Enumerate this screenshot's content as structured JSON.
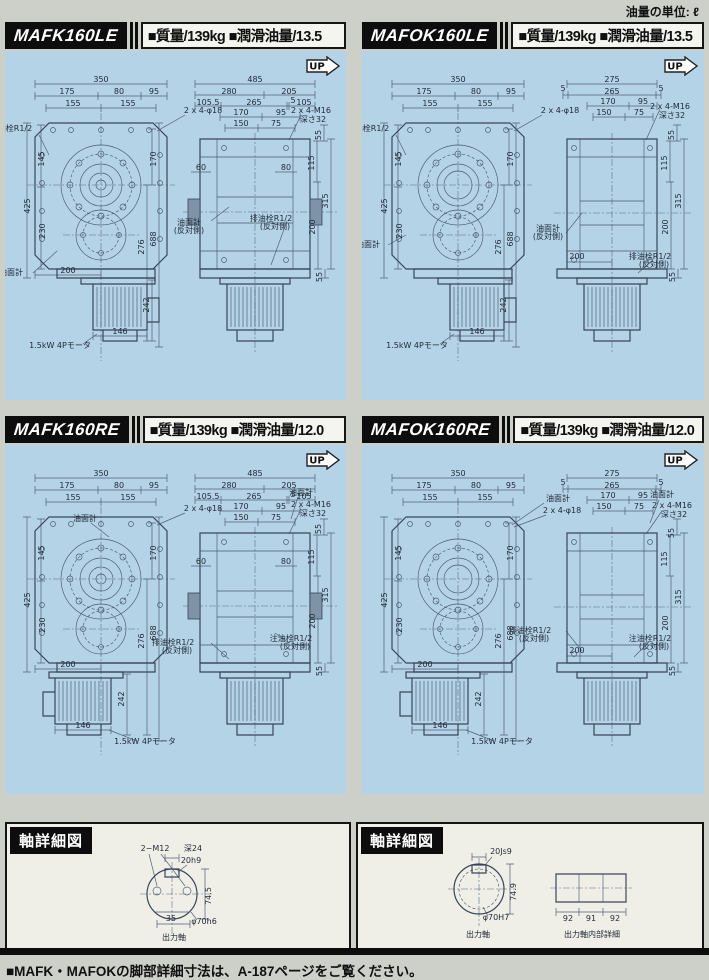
{
  "page": {
    "unit_note": "油量の単位: ℓ",
    "up_label": "UP",
    "footer": "■MAFK・MAFOKの脚部詳細寸法は、A-187ページをご覧ください。"
  },
  "panels": [
    {
      "model": "MAFK160LE",
      "specs": "■質量/139kg ■潤滑油量/13.5",
      "front": [
        {
          "t": "350",
          "x": 96,
          "y": 31
        },
        {
          "t": "175",
          "x": 62,
          "y": 43
        },
        {
          "t": "80",
          "x": 114,
          "y": 43
        },
        {
          "t": "95",
          "x": 149,
          "y": 43
        },
        {
          "t": "155",
          "x": 68,
          "y": 55
        },
        {
          "t": "155",
          "x": 123,
          "y": 55
        },
        {
          "t": "2 x 4-φ18",
          "x": 198,
          "y": 62
        },
        {
          "t": "注油栓R1/2",
          "x": 6,
          "y": 80,
          "a": "start"
        },
        {
          "t": "145",
          "x": 39,
          "y": 108,
          "r": -90
        },
        {
          "t": "425",
          "x": 25,
          "y": 155,
          "r": -90
        },
        {
          "t": "230",
          "x": 40,
          "y": 180,
          "r": -90
        },
        {
          "t": "170",
          "x": 151,
          "y": 108,
          "r": -90
        },
        {
          "t": "276",
          "x": 139,
          "y": 196,
          "r": -90
        },
        {
          "t": "688",
          "x": 151,
          "y": 188,
          "r": -90
        },
        {
          "t": "油面計",
          "x": 6,
          "y": 224,
          "a": "start"
        },
        {
          "t": "200",
          "x": 63,
          "y": 222
        },
        {
          "t": "242",
          "x": 144,
          "y": 254,
          "r": -90
        },
        {
          "t": "146",
          "x": 115,
          "y": 283
        },
        {
          "t": "1.5kW 4Pモータ",
          "x": 55,
          "y": 297
        }
      ],
      "side": [
        {
          "t": "485",
          "x": 250,
          "y": 31
        },
        {
          "t": "280",
          "x": 224,
          "y": 43
        },
        {
          "t": "205",
          "x": 284,
          "y": 43
        },
        {
          "t": "105.5",
          "x": 203,
          "y": 54
        },
        {
          "t": "265",
          "x": 249,
          "y": 54
        },
        {
          "t": "5",
          "x": 288,
          "y": 52
        },
        {
          "t": "105",
          "x": 299,
          "y": 54
        },
        {
          "t": "170",
          "x": 236,
          "y": 64
        },
        {
          "t": "95",
          "x": 276,
          "y": 64
        },
        {
          "t": "150",
          "x": 236,
          "y": 75
        },
        {
          "t": "75",
          "x": 271,
          "y": 75
        },
        {
          "t": "2 x 4-M16",
          "x": 306,
          "y": 62
        },
        {
          "t": "深さ32",
          "x": 308,
          "y": 71
        },
        {
          "t": "60",
          "x": 196,
          "y": 119
        },
        {
          "t": "80",
          "x": 281,
          "y": 119
        },
        {
          "t": "55",
          "x": 316,
          "y": 84,
          "r": -90
        },
        {
          "t": "115",
          "x": 309,
          "y": 112,
          "r": -90
        },
        {
          "t": "315",
          "x": 323,
          "y": 150,
          "r": -90
        },
        {
          "t": "200",
          "x": 310,
          "y": 176,
          "r": -90
        },
        {
          "t": "55",
          "x": 317,
          "y": 226,
          "r": -90
        },
        {
          "t": "油面計",
          "x": 184,
          "y": 174,
          "a": "start"
        },
        {
          "t": "(反対側)",
          "x": 184,
          "y": 182,
          "a": "start"
        },
        {
          "t": "排油栓R1/2",
          "x": 266,
          "y": 170,
          "a": "start"
        },
        {
          "t": "(反対側)",
          "x": 270,
          "y": 178,
          "a": "start"
        }
      ]
    },
    {
      "model": "MAFOK160LE",
      "specs": "■質量/139kg ■潤滑油量/13.5",
      "front": [
        {
          "t": "350",
          "x": 96,
          "y": 31
        },
        {
          "t": "175",
          "x": 62,
          "y": 43
        },
        {
          "t": "80",
          "x": 114,
          "y": 43
        },
        {
          "t": "95",
          "x": 149,
          "y": 43
        },
        {
          "t": "155",
          "x": 68,
          "y": 55
        },
        {
          "t": "155",
          "x": 123,
          "y": 55
        },
        {
          "t": "2 x 4-φ18",
          "x": 198,
          "y": 62
        },
        {
          "t": "注油栓R1/2",
          "x": 6,
          "y": 80,
          "a": "start"
        },
        {
          "t": "145",
          "x": 39,
          "y": 108,
          "r": -90
        },
        {
          "t": "425",
          "x": 25,
          "y": 155,
          "r": -90
        },
        {
          "t": "230",
          "x": 40,
          "y": 180,
          "r": -90
        },
        {
          "t": "170",
          "x": 151,
          "y": 108,
          "r": -90
        },
        {
          "t": "276",
          "x": 139,
          "y": 196,
          "r": -90
        },
        {
          "t": "688",
          "x": 151,
          "y": 188,
          "r": -90
        },
        {
          "t": "油面計",
          "x": 6,
          "y": 196,
          "a": "start"
        },
        {
          "t": "242",
          "x": 144,
          "y": 254,
          "r": -90
        },
        {
          "t": "146",
          "x": 115,
          "y": 283
        },
        {
          "t": "1.5kW 4Pモータ",
          "x": 55,
          "y": 297
        }
      ],
      "side": [
        {
          "t": "275",
          "x": 250,
          "y": 31
        },
        {
          "t": "265",
          "x": 250,
          "y": 43
        },
        {
          "t": "5",
          "x": 201,
          "y": 40
        },
        {
          "t": "5",
          "x": 299,
          "y": 40
        },
        {
          "t": "170",
          "x": 246,
          "y": 53
        },
        {
          "t": "95",
          "x": 281,
          "y": 53
        },
        {
          "t": "150",
          "x": 242,
          "y": 64
        },
        {
          "t": "75",
          "x": 277,
          "y": 64
        },
        {
          "t": "2 x 4-M16",
          "x": 308,
          "y": 58
        },
        {
          "t": "深さ32",
          "x": 310,
          "y": 67
        },
        {
          "t": "55",
          "x": 312,
          "y": 84,
          "r": -90
        },
        {
          "t": "115",
          "x": 305,
          "y": 112,
          "r": -90
        },
        {
          "t": "315",
          "x": 319,
          "y": 150,
          "r": -90
        },
        {
          "t": "200",
          "x": 306,
          "y": 176,
          "r": -90
        },
        {
          "t": "55",
          "x": 313,
          "y": 226,
          "r": -90
        },
        {
          "t": "油面計",
          "x": 186,
          "y": 180,
          "a": "start"
        },
        {
          "t": "(反対側)",
          "x": 186,
          "y": 188,
          "a": "start"
        },
        {
          "t": "200",
          "x": 215,
          "y": 208
        },
        {
          "t": "排油栓R1/2",
          "x": 288,
          "y": 208,
          "a": "start"
        },
        {
          "t": "(反対側)",
          "x": 292,
          "y": 216,
          "a": "start"
        }
      ]
    },
    {
      "model": "MAFK160RE",
      "specs": "■質量/139kg ■潤滑油量/12.0",
      "front": [
        {
          "t": "350",
          "x": 96,
          "y": 31
        },
        {
          "t": "175",
          "x": 62,
          "y": 43
        },
        {
          "t": "80",
          "x": 114,
          "y": 43
        },
        {
          "t": "95",
          "x": 149,
          "y": 43
        },
        {
          "t": "155",
          "x": 68,
          "y": 55
        },
        {
          "t": "155",
          "x": 123,
          "y": 55
        },
        {
          "t": "2 x 4-φ18",
          "x": 198,
          "y": 66
        },
        {
          "t": "油面計",
          "x": 80,
          "y": 76
        },
        {
          "t": "145",
          "x": 39,
          "y": 108,
          "r": -90
        },
        {
          "t": "425",
          "x": 25,
          "y": 155,
          "r": -90
        },
        {
          "t": "230",
          "x": 40,
          "y": 180,
          "r": -90
        },
        {
          "t": "170",
          "x": 151,
          "y": 108,
          "r": -90
        },
        {
          "t": "276",
          "x": 139,
          "y": 196,
          "r": -90
        },
        {
          "t": "688",
          "x": 151,
          "y": 188,
          "r": -90
        },
        {
          "t": "200",
          "x": 63,
          "y": 222
        },
        {
          "t": "242",
          "x": 119,
          "y": 254,
          "r": -90
        },
        {
          "t": "146",
          "x": 78,
          "y": 283
        },
        {
          "t": "1.5kW 4Pモータ",
          "x": 140,
          "y": 299
        }
      ],
      "side": [
        {
          "t": "485",
          "x": 250,
          "y": 31
        },
        {
          "t": "280",
          "x": 224,
          "y": 43
        },
        {
          "t": "205",
          "x": 284,
          "y": 43
        },
        {
          "t": "105.5",
          "x": 203,
          "y": 54
        },
        {
          "t": "265",
          "x": 249,
          "y": 54
        },
        {
          "t": "5",
          "x": 288,
          "y": 52
        },
        {
          "t": "105",
          "x": 299,
          "y": 54
        },
        {
          "t": "170",
          "x": 236,
          "y": 64
        },
        {
          "t": "95",
          "x": 276,
          "y": 64
        },
        {
          "t": "150",
          "x": 236,
          "y": 75
        },
        {
          "t": "75",
          "x": 271,
          "y": 75
        },
        {
          "t": "油面計",
          "x": 296,
          "y": 50
        },
        {
          "t": "2 x 4-M16",
          "x": 306,
          "y": 62
        },
        {
          "t": "深さ32",
          "x": 308,
          "y": 71
        },
        {
          "t": "60",
          "x": 196,
          "y": 119
        },
        {
          "t": "80",
          "x": 281,
          "y": 119
        },
        {
          "t": "55",
          "x": 316,
          "y": 84,
          "r": -90
        },
        {
          "t": "115",
          "x": 309,
          "y": 112,
          "r": -90
        },
        {
          "t": "315",
          "x": 323,
          "y": 150,
          "r": -90
        },
        {
          "t": "200",
          "x": 310,
          "y": 176,
          "r": -90
        },
        {
          "t": "55",
          "x": 317,
          "y": 226,
          "r": -90
        },
        {
          "t": "排油栓R1/2",
          "x": 168,
          "y": 200,
          "a": "start"
        },
        {
          "t": "(反対側)",
          "x": 172,
          "y": 208,
          "a": "start"
        },
        {
          "t": "注油栓R1/2",
          "x": 286,
          "y": 196,
          "a": "start"
        },
        {
          "t": "(反対側)",
          "x": 290,
          "y": 204,
          "a": "start"
        }
      ]
    },
    {
      "model": "MAFOK160RE",
      "specs": "■質量/139kg ■潤滑油量/12.0",
      "front": [
        {
          "t": "350",
          "x": 96,
          "y": 31
        },
        {
          "t": "175",
          "x": 62,
          "y": 43
        },
        {
          "t": "80",
          "x": 114,
          "y": 43
        },
        {
          "t": "95",
          "x": 149,
          "y": 43
        },
        {
          "t": "155",
          "x": 68,
          "y": 55
        },
        {
          "t": "155",
          "x": 123,
          "y": 55
        },
        {
          "t": "油面計",
          "x": 196,
          "y": 56
        },
        {
          "t": "2 x 4-φ18",
          "x": 200,
          "y": 68
        },
        {
          "t": "145",
          "x": 39,
          "y": 108,
          "r": -90
        },
        {
          "t": "425",
          "x": 25,
          "y": 155,
          "r": -90
        },
        {
          "t": "230",
          "x": 40,
          "y": 180,
          "r": -90
        },
        {
          "t": "170",
          "x": 151,
          "y": 108,
          "r": -90
        },
        {
          "t": "276",
          "x": 139,
          "y": 196,
          "r": -90
        },
        {
          "t": "688",
          "x": 151,
          "y": 188,
          "r": -90
        },
        {
          "t": "200",
          "x": 63,
          "y": 222
        },
        {
          "t": "242",
          "x": 119,
          "y": 254,
          "r": -90
        },
        {
          "t": "146",
          "x": 78,
          "y": 283
        },
        {
          "t": "1.5kW 4Pモータ",
          "x": 140,
          "y": 299
        }
      ],
      "side": [
        {
          "t": "275",
          "x": 250,
          "y": 31
        },
        {
          "t": "265",
          "x": 250,
          "y": 43
        },
        {
          "t": "5",
          "x": 201,
          "y": 40
        },
        {
          "t": "5",
          "x": 299,
          "y": 40
        },
        {
          "t": "170",
          "x": 246,
          "y": 53
        },
        {
          "t": "95",
          "x": 281,
          "y": 53
        },
        {
          "t": "150",
          "x": 242,
          "y": 64
        },
        {
          "t": "75",
          "x": 277,
          "y": 64
        },
        {
          "t": "油面計",
          "x": 300,
          "y": 52
        },
        {
          "t": "2 x 4-M16",
          "x": 310,
          "y": 63
        },
        {
          "t": "深さ32",
          "x": 312,
          "y": 72
        },
        {
          "t": "55",
          "x": 312,
          "y": 88,
          "r": -90
        },
        {
          "t": "115",
          "x": 305,
          "y": 114,
          "r": -90
        },
        {
          "t": "315",
          "x": 319,
          "y": 152,
          "r": -90
        },
        {
          "t": "200",
          "x": 306,
          "y": 178,
          "r": -90
        },
        {
          "t": "55",
          "x": 313,
          "y": 226,
          "r": -90
        },
        {
          "t": "排油栓R1/2",
          "x": 168,
          "y": 188,
          "a": "start"
        },
        {
          "t": "(反対側)",
          "x": 172,
          "y": 196,
          "a": "start"
        },
        {
          "t": "注油栓R1/2",
          "x": 288,
          "y": 196,
          "a": "start"
        },
        {
          "t": "(反対側)",
          "x": 292,
          "y": 204,
          "a": "start"
        },
        {
          "t": "200",
          "x": 215,
          "y": 208
        }
      ]
    }
  ],
  "shaft_panels": [
    {
      "title": "軸詳細図",
      "labels": [
        {
          "t": "2−M12",
          "x": 148,
          "y": 27
        },
        {
          "t": "深24",
          "x": 186,
          "y": 27
        },
        {
          "t": "20h9",
          "x": 184,
          "y": 39
        },
        {
          "t": "74.5",
          "x": 204,
          "y": 72,
          "r": -90
        },
        {
          "t": "35",
          "x": 164,
          "y": 97
        },
        {
          "t": "φ70h6",
          "x": 197,
          "y": 100
        },
        {
          "t": "出力軸",
          "x": 167,
          "y": 116,
          "s": 9
        }
      ]
    },
    {
      "title": "軸詳細図",
      "labels": [
        {
          "t": "20Js9",
          "x": 143,
          "y": 30
        },
        {
          "t": "74.9",
          "x": 158,
          "y": 68,
          "r": -90
        },
        {
          "t": "φ70H7",
          "x": 138,
          "y": 96
        },
        {
          "t": "出力軸",
          "x": 120,
          "y": 113,
          "s": 9
        },
        {
          "t": "92",
          "x": 210,
          "y": 97
        },
        {
          "t": "91",
          "x": 233,
          "y": 97
        },
        {
          "t": "92",
          "x": 257,
          "y": 97
        },
        {
          "t": "出力軸内部詳細",
          "x": 234,
          "y": 113,
          "s": 9
        }
      ]
    }
  ]
}
